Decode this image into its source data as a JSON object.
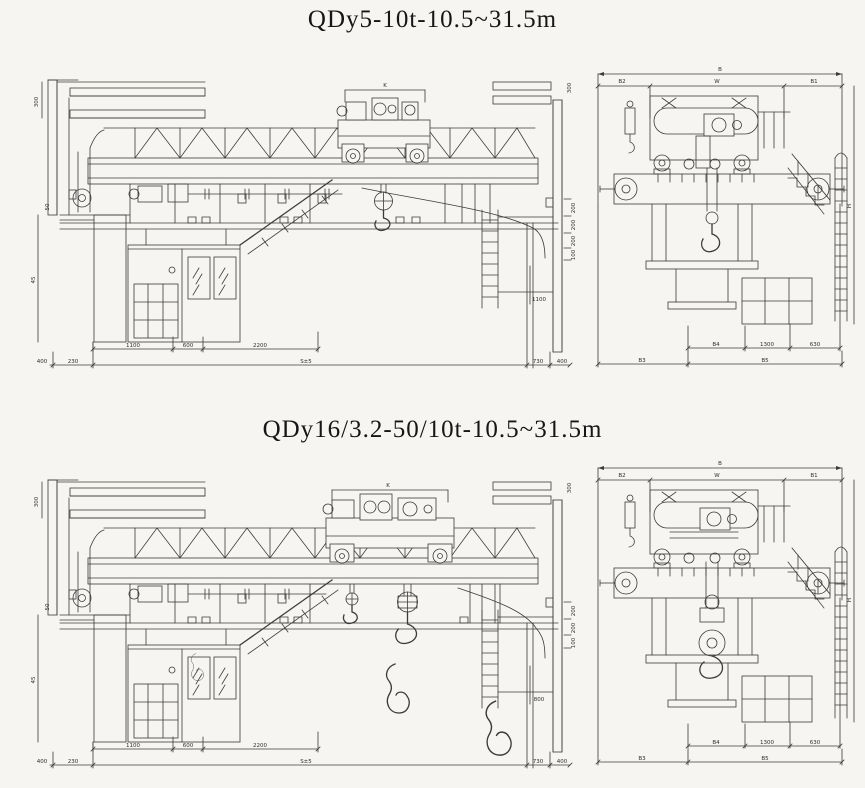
{
  "sheet": {
    "background": "#f6f5f1",
    "ink": "#3b3b3b"
  },
  "drawings": [
    {
      "title": "QDy5-10t-10.5~31.5m",
      "front": {
        "trolley_dim": "K",
        "left_dims": {
          "top": "300",
          "mid": "50",
          "bottom": "45"
        },
        "wall_dims": [
          "200",
          "200",
          "200",
          "100"
        ],
        "ladder_dim": "1100",
        "clearance_dim": "300",
        "cab_dims": [
          "1100",
          "600",
          "2200"
        ],
        "ground_dims": {
          "far_left": "400",
          "left": "230",
          "span": "S±5",
          "right": "730",
          "far_right": "400"
        }
      },
      "end": {
        "overall_width": "B",
        "top_dims": [
          "B2",
          "W",
          "B1"
        ],
        "bottom_dims_upper": [
          "B4",
          "1300",
          "630"
        ],
        "bottom_dims_lower": [
          "B3",
          "B5"
        ],
        "height_dim": "H"
      }
    },
    {
      "title": "QDy16/3.2-50/10t-10.5~31.5m",
      "front": {
        "trolley_dim": "K",
        "left_dims": {
          "top": "300",
          "mid": "50",
          "bottom": "45"
        },
        "wall_dims": [
          "200",
          "200",
          "100"
        ],
        "ladder_dim": "800",
        "clearance_dim": "300",
        "cab_dims": [
          "1100",
          "600",
          "2200"
        ],
        "ground_dims": {
          "far_left": "400",
          "left": "230",
          "span": "S±5",
          "right": "730",
          "far_right": "400"
        }
      },
      "end": {
        "overall_width": "B",
        "top_dims": [
          "B2",
          "W",
          "B1"
        ],
        "bottom_dims_upper": [
          "B4",
          "1300",
          "630"
        ],
        "bottom_dims_lower": [
          "B3",
          "B5"
        ],
        "height_dim": "H"
      }
    }
  ]
}
